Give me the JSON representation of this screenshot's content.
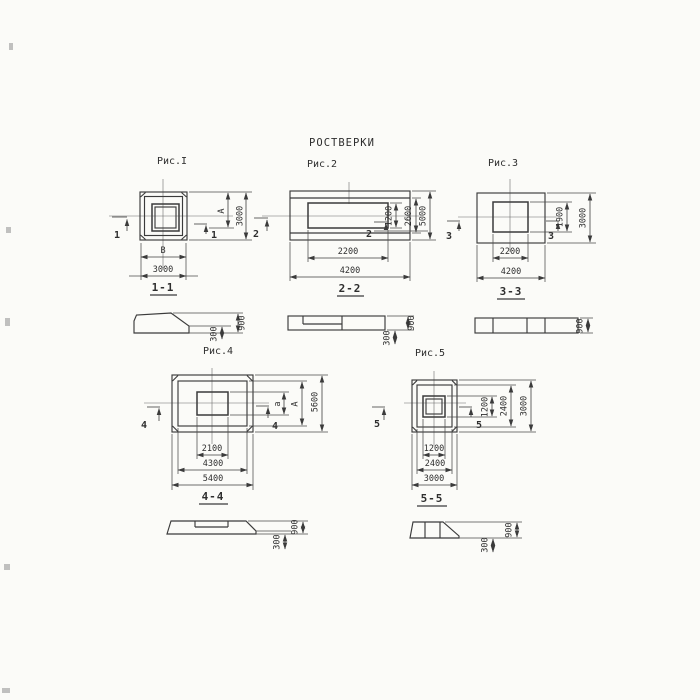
{
  "title": "РОСТВЕРКИ",
  "fig1": {
    "label": "Рис.I",
    "section": "1-1",
    "mark": "1",
    "dims": {
      "inner_width": "В",
      "bottom": "3000",
      "right_inner": "А",
      "right_outer": "3000"
    },
    "section_dims": {
      "h_total": "900",
      "h_edge": "300"
    }
  },
  "fig2": {
    "label": "Рис.2",
    "section": "2-2",
    "mark": "2",
    "dims": {
      "inner_width": "2200",
      "bottom": "4200",
      "right_inner": "1200",
      "right_mid": "2600",
      "right_outer": "5000"
    },
    "section_dims": {
      "h_total": "900",
      "h_edge": "300"
    }
  },
  "fig3": {
    "label": "Рис.3",
    "section": "3-3",
    "mark": "3",
    "dims": {
      "inner_width": "2200",
      "bottom": "4200",
      "right_inner": "1900",
      "right_outer": "3000"
    },
    "section_dims": {
      "h_total": "900"
    }
  },
  "fig4": {
    "label": "Рис.4",
    "section": "4-4",
    "mark": "4",
    "dims": {
      "inner_width": "2100",
      "mid": "4300",
      "bottom": "5400",
      "right_inner": "а",
      "right_mid": "А",
      "right_outer": "5600"
    },
    "section_dims": {
      "h_total": "900",
      "h_edge": "300"
    }
  },
  "fig5": {
    "label": "Рис.5",
    "section": "5-5",
    "mark": "5",
    "dims": {
      "inner_width": "1200",
      "mid": "2400",
      "bottom": "3000",
      "right_inner": "1200",
      "right_mid": "2400",
      "right_outer": "3000"
    },
    "section_dims": {
      "h_total": "900",
      "h_edge": "300"
    }
  },
  "colors": {
    "ink": "#3b3b3b",
    "paper": "#fbfbf8"
  }
}
